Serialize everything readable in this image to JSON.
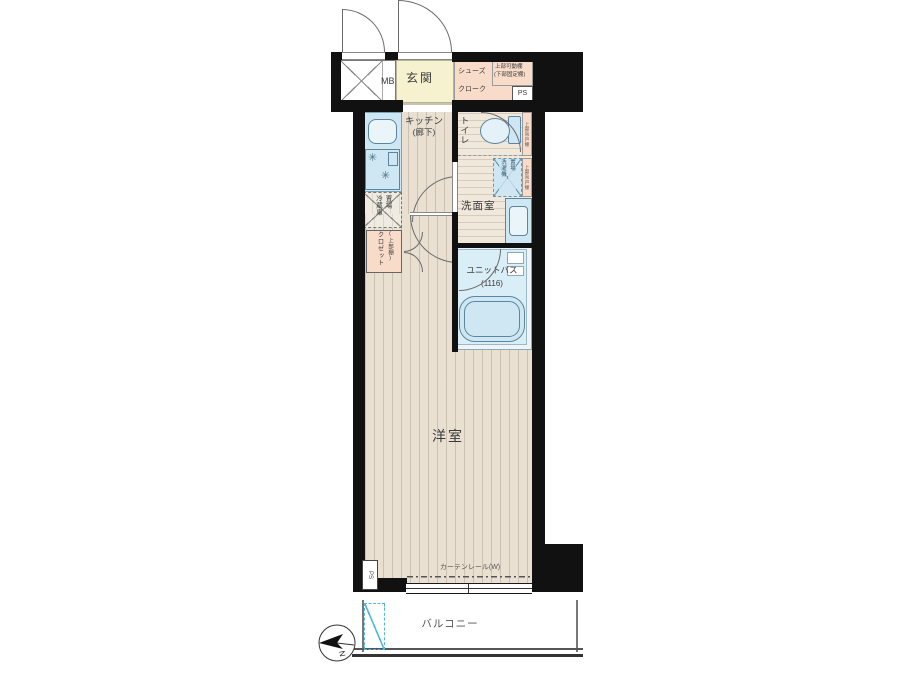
{
  "labels": {
    "mb": "MB",
    "genkan": "玄関",
    "shoe_cloak_1": "シューズ",
    "shoe_cloak_2": "クローク",
    "shelf_note_1": "上部可動棚",
    "shelf_note_2": "(下部固定棚)",
    "ps_top": "PS",
    "kitchen_1": "キッチン",
    "kitchen_2": "(廊下)",
    "toilet": "トイレ",
    "toilet_shelf": "上部吊戸棚",
    "fridge_1": "冷蔵庫",
    "fridge_2": "置場",
    "closet_1": "クロゼット",
    "closet_2": "(上部棚)",
    "washer_1": "洗濯機",
    "washer_2": "置場",
    "washer_shelf": "上部吊戸棚",
    "washroom": "洗面室",
    "unit_bath": "ユニットバス",
    "unit_bath_size": "(1116)",
    "western_room": "洋室",
    "ps_bottom": "PS",
    "curtain_rail": "カーテンレール(W)",
    "balcony": "バルコニー",
    "compass_north": "N"
  },
  "colors": {
    "wall": "#111111",
    "floor-wood": "#e9e0d2",
    "floor-service": "#f1e8dc",
    "genkan": "#f6f2cf",
    "pink": "#f8dcc9",
    "fixture": "#cfe7f2",
    "fixture-line": "#5b85a0",
    "bath-floor": "#d9eef6",
    "partition": "#4fb6dd"
  }
}
